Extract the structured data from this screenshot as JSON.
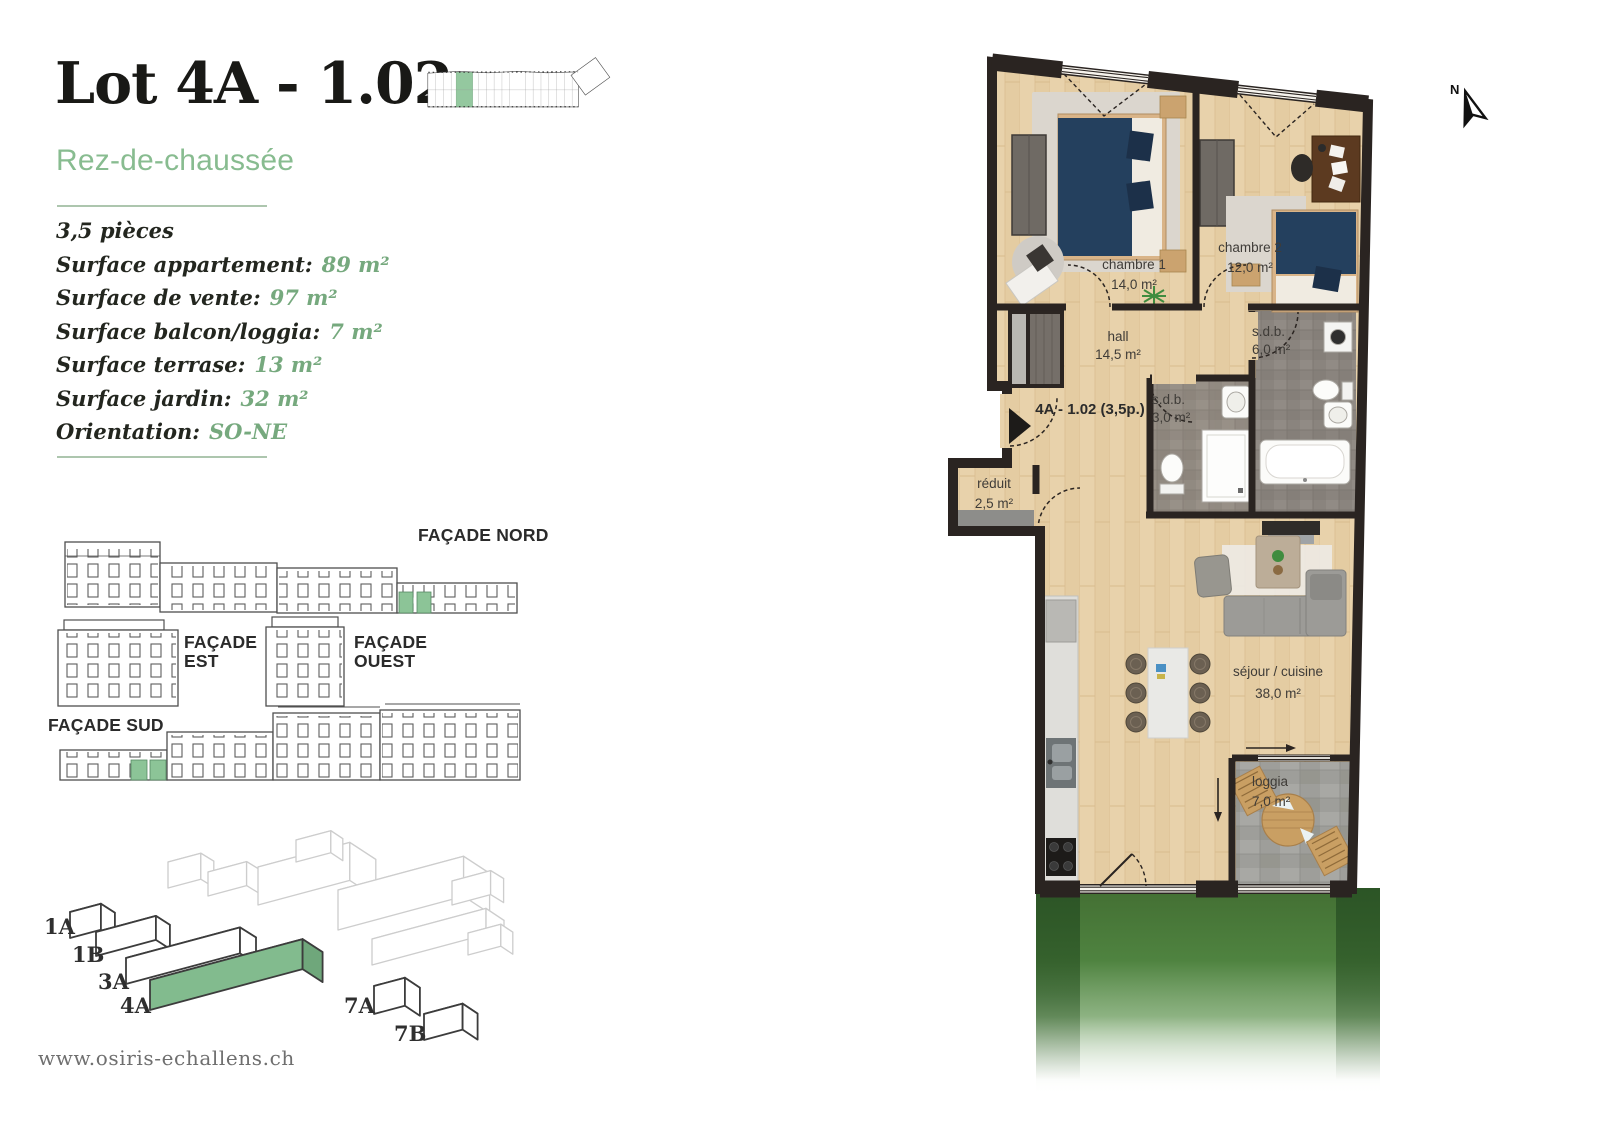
{
  "header": {
    "title": "Lot 4A - 1.02",
    "subtitle": "Rez-de-chaussée"
  },
  "details": {
    "rooms_line": "3,5 pièces",
    "items": [
      {
        "label": "Surface appartement:",
        "value": "89 m²"
      },
      {
        "label": "Surface de vente:",
        "value": "97 m²"
      },
      {
        "label": "Surface balcon/loggia:",
        "value": "7 m²"
      },
      {
        "label": "Surface terrase:",
        "value": "13 m²"
      },
      {
        "label": "Surface jardin:",
        "value": "32 m²"
      },
      {
        "label": "Orientation:",
        "value": "SO-NE"
      }
    ]
  },
  "facades": {
    "nord": "FAÇADE NORD",
    "est": "FAÇADE EST",
    "ouest": "FAÇADE OUEST",
    "sud": "FAÇADE SUD"
  },
  "site_blocks": {
    "labels": [
      "1A",
      "1B",
      "3A",
      "4A",
      "7A",
      "7B"
    ],
    "highlighted": "4A"
  },
  "floorplan": {
    "unit_label": "4A - 1.02 (3,5p.)",
    "north_label": "N",
    "rooms": [
      {
        "name": "chambre 1",
        "area": "14,0 m²"
      },
      {
        "name": "chambre 2",
        "area": "12,0 m²"
      },
      {
        "name": "hall",
        "area": "14,5 m²"
      },
      {
        "name": "s.d.b.",
        "area": "6,0 m²"
      },
      {
        "name": "s.d.b.",
        "area": "3,0 m²"
      },
      {
        "name": "réduit",
        "area": "2,5 m²"
      },
      {
        "name": "séjour / cuisine",
        "area": "38,0 m²"
      },
      {
        "name": "loggia",
        "area": "7,0 m²"
      }
    ]
  },
  "footer": {
    "website": "www.osiris-echallens.ch"
  },
  "colors": {
    "accent_green": "#88BC90",
    "value_green": "#76A97E",
    "highlight_green": "#8CC497",
    "wall_dark": "#2A2421",
    "wood_floor": "#E8D2AB",
    "tile_gray": "#8A847E",
    "grass_green": "#47793A"
  }
}
